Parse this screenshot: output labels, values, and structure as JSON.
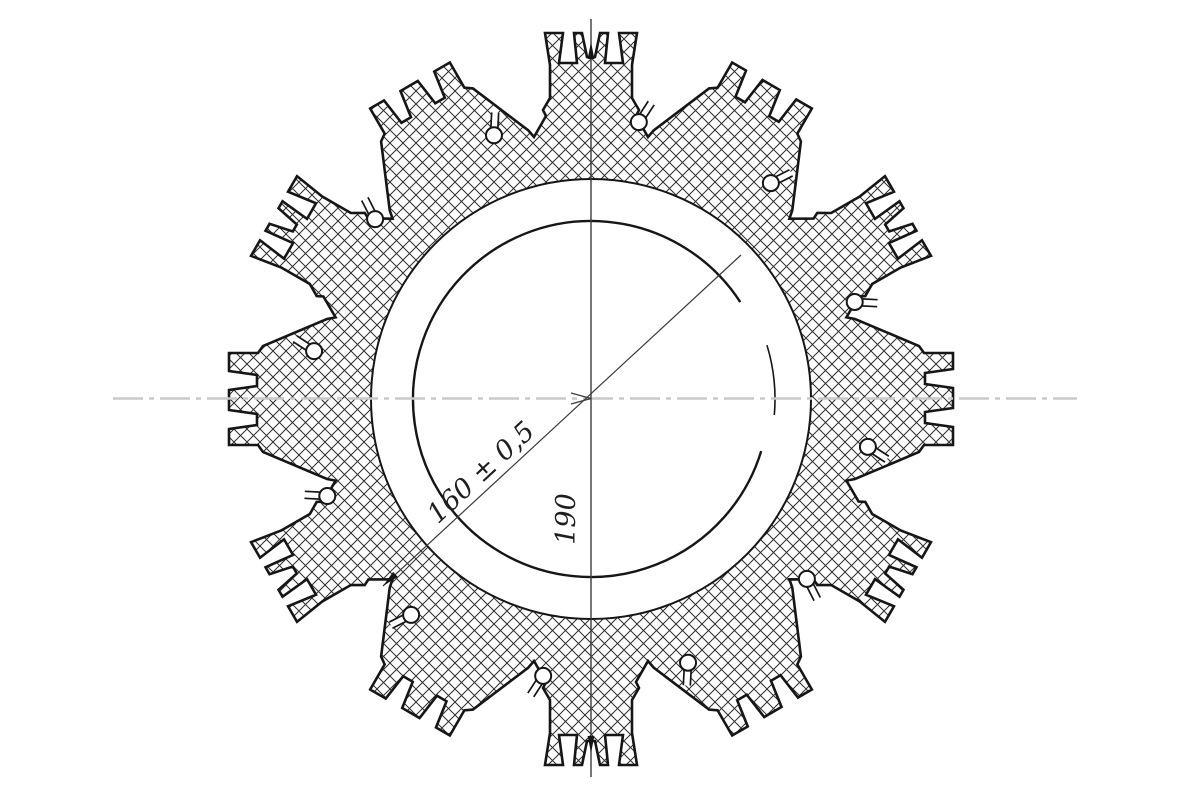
{
  "drawing": {
    "canvas": {
      "width": 1200,
      "height": 800,
      "background": "#ffffff"
    },
    "colors": {
      "outline": "#161616",
      "hatch": "#2e2e2e",
      "thin_line": "#3c3c3c",
      "centerline": "#c9c9c9",
      "text": "#1f1f1f",
      "white": "#ffffff"
    },
    "center": {
      "x": 591,
      "y": 399
    },
    "gear": {
      "tooth_count": 12,
      "start_angle_deg": 90,
      "step_deg": -30,
      "tip_radius": 366,
      "body_inner_radius": 220,
      "bore_radius": 178,
      "outline_width": 2.6,
      "inner_circle_width": 2.0,
      "bore_circle_width": 2.4,
      "hatch_spacing": 13,
      "hatch_width": 1.0,
      "castle_profile": [
        [
          -57,
          262
        ],
        [
          -45,
          283
        ],
        [
          -48,
          289
        ],
        [
          -41,
          301
        ],
        [
          -41,
          334
        ],
        [
          -46,
          366
        ],
        [
          -28,
          366
        ],
        [
          -32,
          336
        ],
        [
          -14,
          336
        ],
        [
          -17,
          366
        ],
        [
          -9,
          366
        ],
        [
          -4,
          342
        ],
        [
          4,
          342
        ],
        [
          9,
          366
        ],
        [
          17,
          366
        ],
        [
          14,
          336
        ],
        [
          32,
          336
        ],
        [
          28,
          366
        ],
        [
          46,
          366
        ],
        [
          41,
          334
        ],
        [
          41,
          301
        ],
        [
          48,
          289
        ],
        [
          45,
          283
        ],
        [
          57,
          262
        ]
      ],
      "comb_profile": [
        [
          -80,
          264
        ],
        [
          -53,
          328
        ],
        [
          -46,
          333
        ],
        [
          -46,
          362
        ],
        [
          -30,
          362
        ],
        [
          -26,
          334
        ],
        [
          -15,
          334
        ],
        [
          -11,
          362
        ],
        [
          9,
          362
        ],
        [
          13,
          334
        ],
        [
          24,
          334
        ],
        [
          28,
          362
        ],
        [
          46,
          362
        ],
        [
          46,
          333
        ],
        [
          53,
          328
        ],
        [
          80,
          264
        ]
      ],
      "keyhole": {
        "angle_offset_deg": -9.8,
        "orbit_radius": 281,
        "hole_radius": 8,
        "hole_stroke": 2.0,
        "neck_end_offset_deg": -11.5,
        "neck_end_radius": 302,
        "neck_half_width": 3.5,
        "neck_edge_width": 1.7
      }
    },
    "bore_arc": {
      "gap_start_deg": -17,
      "gap_end_deg": 33,
      "stub_radius": 184,
      "stub_from_deg": -5,
      "stub_to_deg": 17,
      "stub_width": 1.6
    },
    "centerline_h": {
      "x1": 113,
      "x2": 1077,
      "y": 398.5,
      "width": 2.6,
      "dash": "30 6 5 6"
    },
    "vertical_line": {
      "x": 591,
      "y1": 19,
      "y2": 777,
      "width": 1.4
    },
    "diagonal_line": {
      "x1": 383,
      "y1": 586,
      "x2": 741,
      "y2": 255,
      "width": 1.2
    },
    "arrows": [
      {
        "name": "diagonal-lower-arrow",
        "tip": [
          383,
          586
        ],
        "angle_deg": 137,
        "length": 17,
        "half_width": 3.4,
        "style": "filled"
      },
      {
        "name": "vertical-top-arrow",
        "tip": [
          591,
          42
        ],
        "angle_deg": -90,
        "length": 17,
        "half_width": 3.4,
        "style": "filled"
      },
      {
        "name": "vertical-bottom-arrow",
        "tip": [
          591,
          753
        ],
        "angle_deg": 90,
        "length": 17,
        "half_width": 3.4,
        "style": "filled"
      },
      {
        "name": "center-open-arrow",
        "tip": [
          591,
          398.5
        ],
        "angle_deg": 0,
        "length": 20,
        "half_width": 5.5,
        "style": "open"
      }
    ],
    "dimensions": {
      "diameter_label": "160 ± 0,5",
      "diameter_label_pos": {
        "x": 487,
        "y": 479,
        "rotate_deg": -42.8
      },
      "outer_label": "190",
      "outer_label_pos": {
        "x": 575,
        "y": 519,
        "rotate_deg": -90
      },
      "font_size": 27
    }
  }
}
